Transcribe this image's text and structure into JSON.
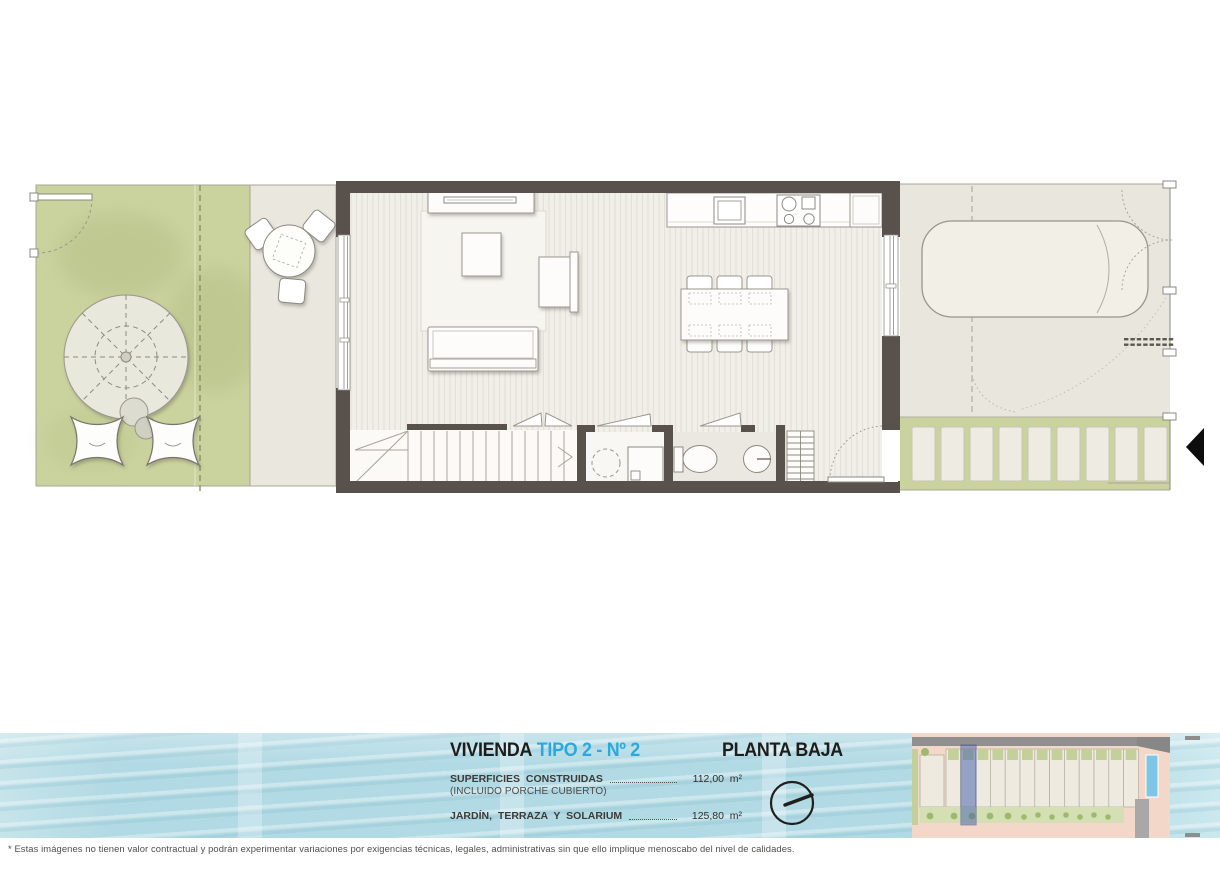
{
  "sheet": {
    "disclaimer": "* Estas imágenes no tienen valor contractual y podrán experimentar variaciones por exigencias técnicas, legales, administrativas sin que ello implique menoscabo del nivel de calidades."
  },
  "title_block": {
    "project_label": "VIVIENDA",
    "unit_label": "TIPO 2 - Nº 2",
    "floor_label": "PLANTA BAJA",
    "accent_color": "#29a9dd",
    "surfaces": [
      {
        "label": "SUPERFICIES CONSTRUIDAS",
        "sublabel": "(INCLUIDO PORCHE CUBIERTO)",
        "value": "112,00",
        "unit": "m²"
      },
      {
        "label": "JARDÍN, TERRAZA Y SOLARIUM",
        "sublabel": "",
        "value": "125,80",
        "unit": "m²"
      }
    ]
  },
  "plan": {
    "features": [
      "garden",
      "parasol",
      "lounge-cushions",
      "covered-porch",
      "porch-table",
      "living-room",
      "sofa",
      "coffee-table",
      "tv-console",
      "armchair",
      "kitchen-counter",
      "sink",
      "cooktop",
      "fridge",
      "dining-table",
      "staircase",
      "utility-room",
      "washing-machine",
      "bathroom",
      "toilet",
      "washbasin",
      "shelving",
      "entry-door",
      "driveway",
      "car",
      "gate",
      "stepping-stones",
      "entrance-arrow"
    ],
    "colors": {
      "walls": "#59514b",
      "garden_green": "#cad29e",
      "paving_beige": "#eae7de",
      "wood_floor": "#f1efe9",
      "water_band": "#b2dae4",
      "site_plan_pink": "#f3d8c9",
      "highlight_unit_blue": "#4f68b0",
      "pool_blue": "#7fc6e6",
      "accent_cyan": "#29a9dd"
    }
  },
  "north_indicator": {
    "icon": "north-indicator-icon"
  },
  "site_key": {
    "icon": "site-plan-key-icon",
    "highlighted_unit": "blue"
  }
}
